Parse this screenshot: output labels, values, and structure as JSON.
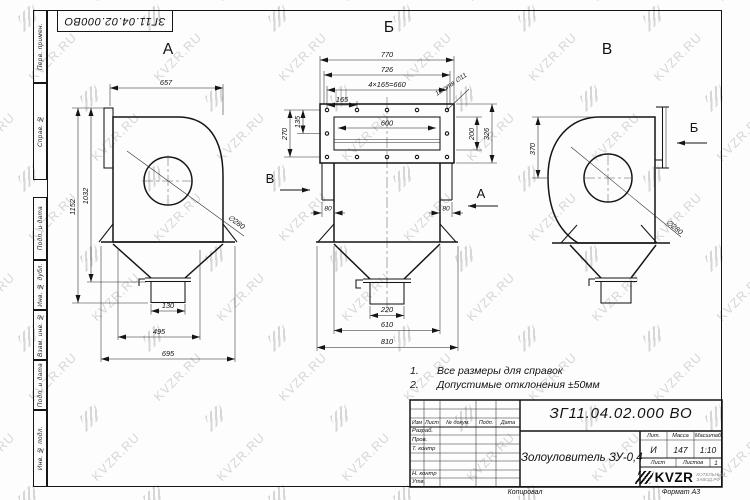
{
  "watermark": {
    "text": "KVZR.RU"
  },
  "top_stamp": {
    "doc_number": "ЗГ11.04.02.000ВО"
  },
  "side_stamp": {
    "labels": [
      "Перв. примен.",
      "Справ. №",
      "Подп. и дата",
      "Инв. № дубл.",
      "Взам. инв. №",
      "Подп. и дата",
      "Инв. № подл."
    ]
  },
  "views": {
    "a": {
      "label": "А",
      "dim_width": "657",
      "dim_height_total": "1152",
      "dim_height_to_flange": "1032",
      "dim_diameter": "∅280",
      "dim_outlet": "130",
      "dim_feet": "495",
      "dim_base": "695"
    },
    "b": {
      "label": "Б",
      "dim_total_width": "770",
      "dim_flange_width": "726",
      "dim_bolt_span": "4×165=660",
      "dim_bolt_pitch": "165",
      "holes_note": "12 отв ∅11",
      "dim_135": "135",
      "dim_270": "270",
      "dim_opening": "600",
      "dim_200": "200",
      "dim_326": "326",
      "dim_duct_left": "80",
      "dim_duct_right": "80",
      "dim_outlet": "220",
      "dim_610": "610",
      "dim_810": "810",
      "arrow_left_label": "В",
      "arrow_right_label": "А"
    },
    "v": {
      "label": "В",
      "dim_370": "370",
      "dim_diameter": "∅280",
      "arrow_label": "Б"
    }
  },
  "notes": {
    "n1_num": "1.",
    "n1_text": "Все размеры для справок",
    "n2_num": "2.",
    "n2_text": "Допустимые отклонения ±50мм"
  },
  "title_block": {
    "doc_number": "ЗГ11.04.02.000 ВО",
    "product_name": "Золоуловитель ЗУ-0,4",
    "header_izm": "Изм",
    "header_list": "Лист",
    "header_doc": "№ докум.",
    "header_sign": "Подп.",
    "header_date": "Дата",
    "row_developed": "Разраб.",
    "row_checked": "Пров.",
    "row_tcontrol": "Т. контр",
    "row_ncontrol": "Н. контр",
    "row_approved": "Утв.",
    "lit_label": "Лит.",
    "mass_label": "Масса",
    "scale_label": "Масштаб",
    "lit_value": "И",
    "mass_value": "147",
    "scale_value": "1:10",
    "sheet_label": "Лист",
    "sheets_label": "Листов",
    "sheets_value": "1",
    "copied_label": "Копировал",
    "format_label": "Формат А3",
    "logo_text": "KVZR",
    "logo_subtext": "КОТЕЛЬНЫЙ ЗАВОД.РФ"
  }
}
